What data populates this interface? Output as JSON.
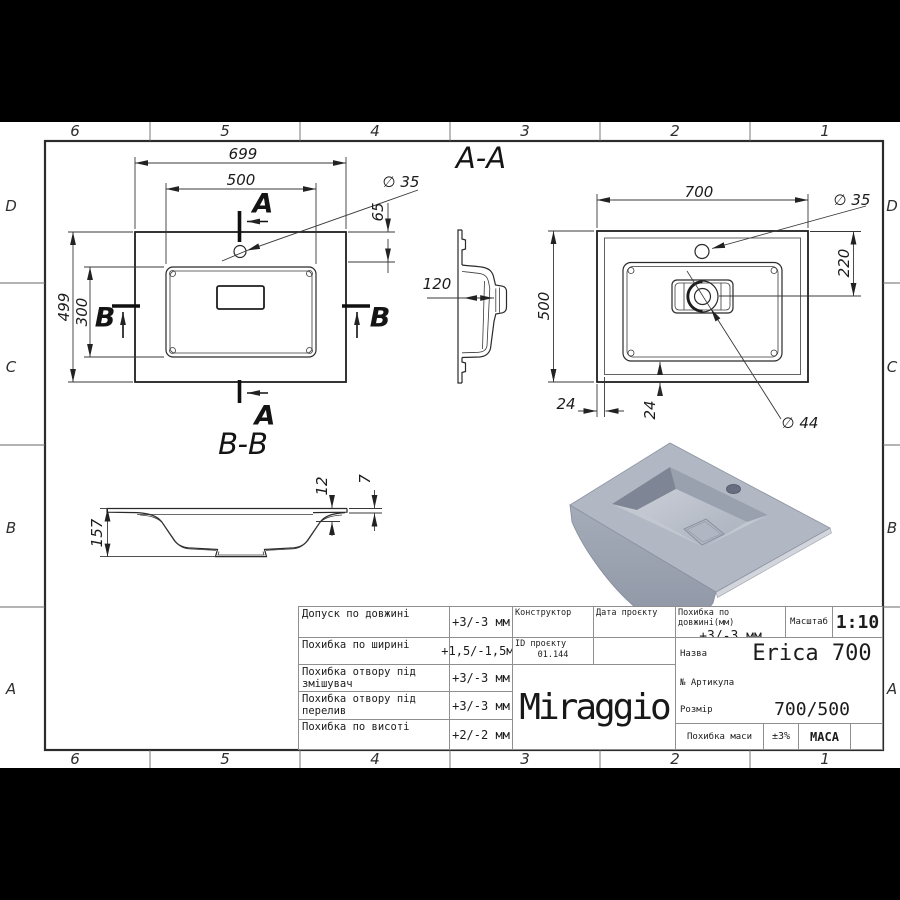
{
  "zones": {
    "columns": [
      "6",
      "5",
      "4",
      "3",
      "2",
      "1"
    ],
    "rows": [
      "D",
      "C",
      "B",
      "A"
    ]
  },
  "drawing": {
    "plan_left": {
      "dim_width": "699",
      "dim_basin_width": "500",
      "dim_hole": "∅ 35",
      "dim_hole_offset": "65",
      "dim_height": "499",
      "dim_basin_height": "300",
      "section_a": "A",
      "section_b": "B"
    },
    "section_aa": {
      "title": "A-A",
      "dim_depth": "120"
    },
    "section_bb": {
      "title": "B-B",
      "dim_height": "157",
      "dim_flange": "12",
      "dim_edge": "7"
    },
    "plan_right": {
      "dim_width": "700",
      "dim_hole": "∅ 35",
      "dim_height": "500",
      "dim_hole_offset": "220",
      "dim_margin_h": "24",
      "dim_margin_v": "24",
      "dim_drain": "∅ 44"
    }
  },
  "title_block": {
    "tolerances": [
      {
        "label": "Допуск по довжині",
        "value": "+3/-3 мм"
      },
      {
        "label": "Похибка по ширині",
        "value": "+1,5/-1,5мм"
      },
      {
        "label": "Похибка отвору під змішувач",
        "value": "+3/-3 мм"
      },
      {
        "label": "Похибка отвору під перелив",
        "value": "+3/-3 мм"
      },
      {
        "label": "Похибка по висоті",
        "value": "+2/-2 мм"
      }
    ],
    "constructor_label": "Конструктор",
    "project_date_label": "Дата проєкту",
    "project_id_label": "ID проєкту",
    "project_id_value": "01.144",
    "brand": "Miraggio",
    "length_tolerance_label": "Похибка по довжині(мм)",
    "length_tolerance_value": "+3/-3 мм",
    "scale_label": "Масштаб",
    "scale_value": "1:10",
    "name_label": "Назва",
    "name_value": "Erica 700",
    "article_label": "№ Артикула",
    "size_label": "Розмір",
    "size_value": "700/500",
    "mass_tolerance_label": "Похибка маси",
    "mass_tolerance_value": "±3%",
    "mass_label": "МАСА"
  }
}
